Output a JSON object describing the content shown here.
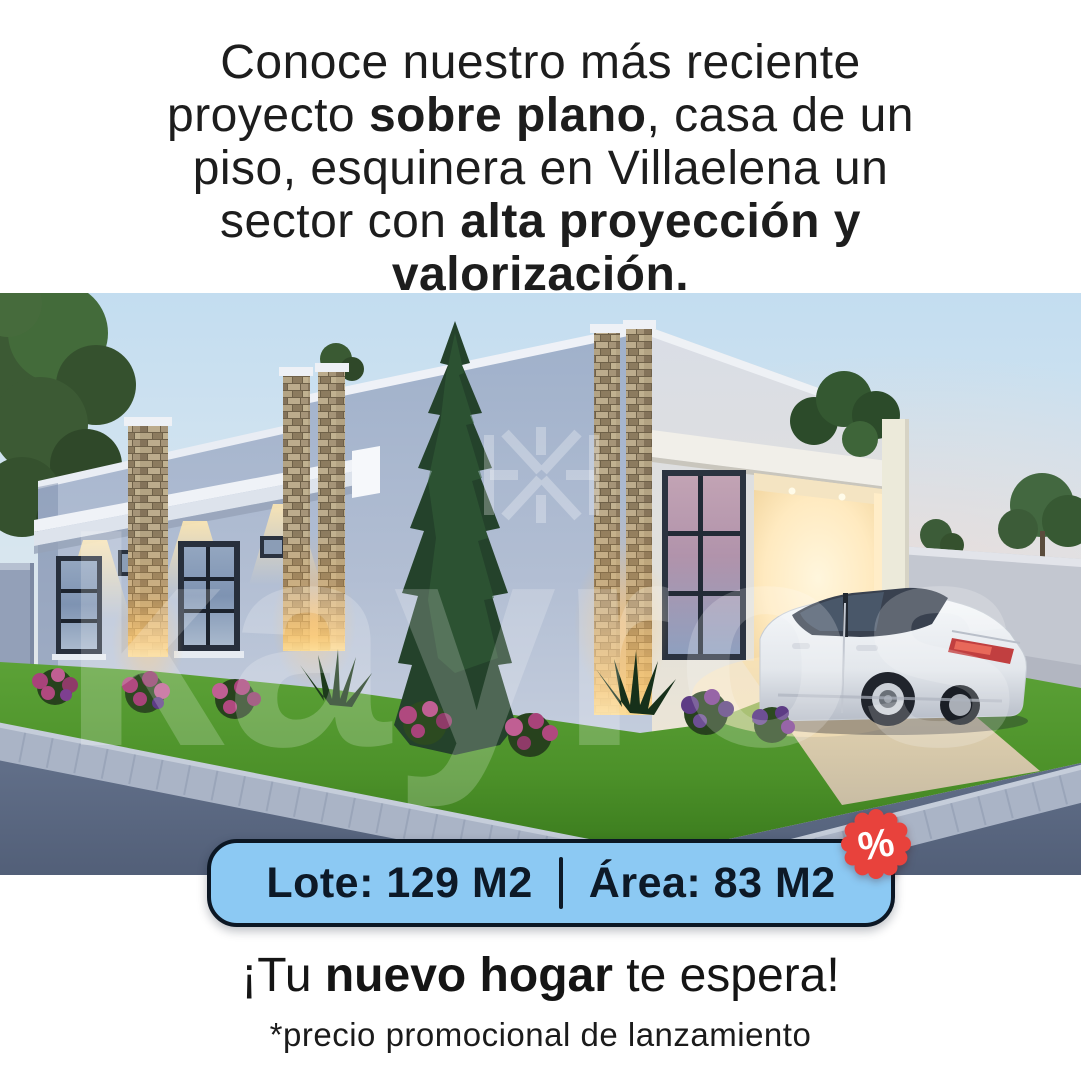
{
  "page": {
    "background": "#ffffff"
  },
  "headline": {
    "line1": "Conoce nuestro más reciente",
    "line2_pre": "proyecto ",
    "line2_bold": "sobre plano",
    "line2_post": ", casa de un",
    "line3": "piso, esquinera en Villaelena un",
    "line4_pre": "sector con ",
    "line4_bold": "alta proyección y",
    "line5_bold": "valorización."
  },
  "photo": {
    "watermark_brand": "kayros",
    "watermark_logo_icon": "brand-mark",
    "scene": "dusk 3D render: single-story corner house with stone pillars, cypress tree, white sedan at lit carport, lawn, sidewalk corner"
  },
  "spec_badge": {
    "lote": "Lote: 129 M2",
    "area": "Área: 83 M2",
    "percent": "%",
    "fill_color": "#8cc9f3",
    "border_color": "#0c1724",
    "discount_color": "#e8423c"
  },
  "tagline": {
    "pre": "¡Tu ",
    "bold": "nuevo hogar",
    "post": " te espera!"
  },
  "disclaimer": "*precio promocional de lanzamiento",
  "colors": {
    "text_dark": "#1d1d1d",
    "sky_top": "#c3ddf0",
    "sunset_pink": "#f6d8c8",
    "wall_blue": "#a9b9d2",
    "stone_tan": "#a08f74",
    "grass_green": "#4c9129",
    "road_gray": "#5b6983",
    "warm_light": "#ffe9bd"
  }
}
